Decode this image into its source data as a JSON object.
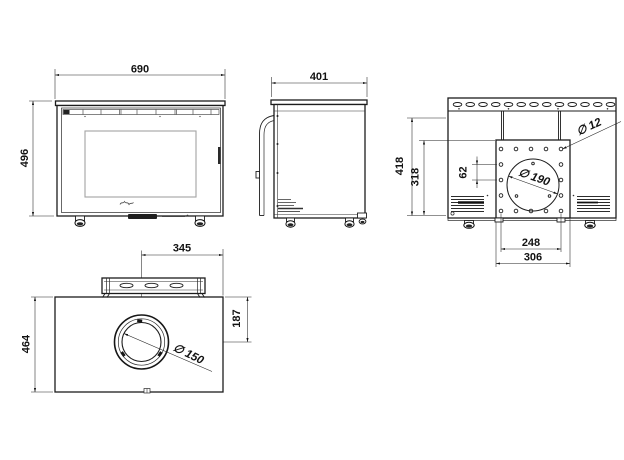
{
  "drawing": {
    "views": {
      "front": {
        "width": "690",
        "height": "496"
      },
      "side": {
        "depth": "401"
      },
      "rear": {
        "overall_height": "418",
        "plate_height": "318",
        "hole_pitch": "62",
        "bolt_hole_dia": "∅ 12",
        "flue_opening_dia": "∅ 190",
        "hole_span": "248",
        "plate_width": "306"
      },
      "plan": {
        "flue_offset_from_right": "345",
        "depth": "464",
        "flue_offset_from_front": "187",
        "flue_collar_dia": "∅ 150"
      }
    }
  }
}
